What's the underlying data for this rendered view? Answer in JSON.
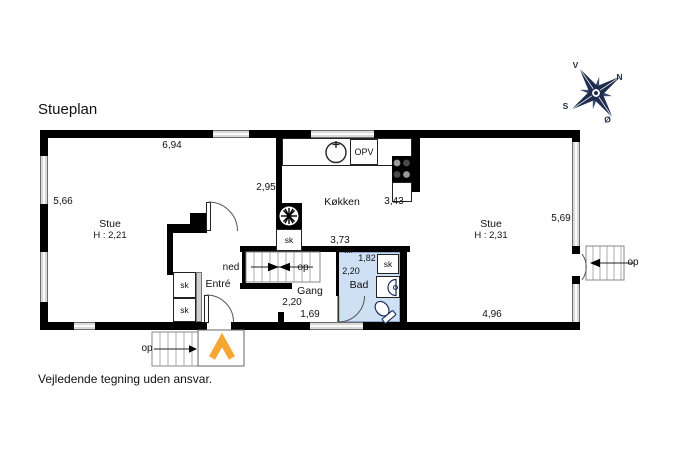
{
  "title": "Stueplan",
  "disclaimer": "Vejledende tegning uden ansvar.",
  "compass": {
    "west": "V",
    "north": "N",
    "south": "S",
    "east": "Ø"
  },
  "rooms": {
    "stue_left": {
      "name": "Stue",
      "ceiling_height": "H : 2,21"
    },
    "stue_right": {
      "name": "Stue",
      "ceiling_height": "H : 2,31"
    },
    "kitchen": {
      "name": "Køkken"
    },
    "entre": {
      "name": "Entré"
    },
    "gang": {
      "name": "Gang"
    },
    "bad": {
      "name": "Bad"
    }
  },
  "labels": {
    "closet": "sk",
    "up": "op",
    "down": "ned",
    "dishwasher": "OPV",
    "washing_machine": "vm"
  },
  "dimensions": {
    "stue_left_top": "6,94",
    "stue_left_side": "5,66",
    "stue_left_opening": "2,95",
    "kitchen_side": "3,43",
    "gang_top": "3,73",
    "gang_width": "2,20",
    "gang_opening": "1,69",
    "bad_width": "1,82",
    "bad_depth": "2,20",
    "stue_right_side": "5,69",
    "stue_right_bottom": "4,96"
  },
  "colors": {
    "wall": "#000000",
    "window": "#d8d8d8",
    "bath_fill": "#cfe0f5",
    "accent_orange": "#f5a733",
    "compass_navy": "#1f2c4e"
  }
}
